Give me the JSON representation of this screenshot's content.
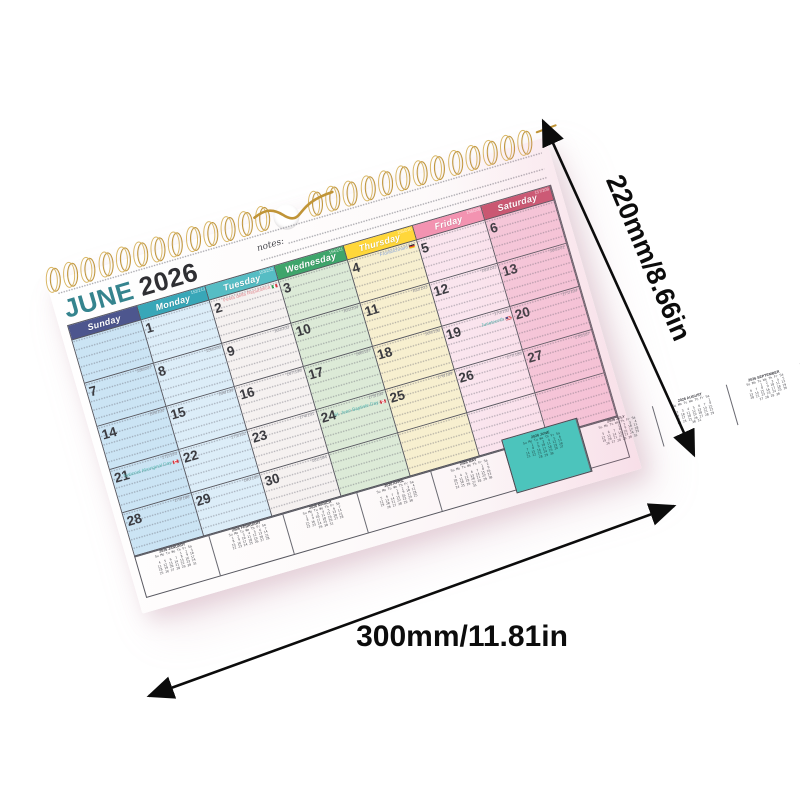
{
  "calendar": {
    "title_month": "JUNE",
    "title_year": "2026",
    "notes_label": "notes:",
    "mini_weekdays": "Su Mo Tu We Th Fr Sa",
    "days": [
      {
        "name": "Sunday",
        "header_num": "",
        "header_color": "#4d568e",
        "cell_color": "#cbe4f4"
      },
      {
        "name": "Monday",
        "header_num": "152/213",
        "header_color": "#38a7b8",
        "cell_color": "#dcedf8"
      },
      {
        "name": "Tuesday",
        "header_num": "153/212",
        "header_color": "#56bdc4",
        "cell_color": "#f5f1f0"
      },
      {
        "name": "Wednesday",
        "header_num": "154/211",
        "header_color": "#3ea56b",
        "cell_color": "#dcead7"
      },
      {
        "name": "Thursday",
        "header_num": "155/210",
        "header_color": "#ffd73a",
        "cell_color": "#f7efcf"
      },
      {
        "name": "Friday",
        "header_num": "156/209",
        "header_color": "#f393b1",
        "cell_color": "#fae5ee"
      },
      {
        "name": "Saturday",
        "header_num": "157/208",
        "header_color": "#c8556f",
        "cell_color": "#f5c9da"
      }
    ],
    "weeks": [
      [
        {
          "d": ""
        },
        {
          "d": "1"
        },
        {
          "d": "2",
          "h": "Festa della Repubblica",
          "f": "it",
          "hc": "#e0888f"
        },
        {
          "d": "3"
        },
        {
          "d": "4",
          "h": "Fronleichnam",
          "f": "de",
          "hc": "#86a3d8"
        },
        {
          "d": "5"
        },
        {
          "d": "6"
        }
      ],
      [
        {
          "d": "7",
          "n": "158/207"
        },
        {
          "d": "8",
          "n": "159/206"
        },
        {
          "d": "9",
          "n": "160/205"
        },
        {
          "d": "10",
          "n": "161/204"
        },
        {
          "d": "11",
          "n": "162/203"
        },
        {
          "d": "12",
          "n": "163/202"
        },
        {
          "d": "13",
          "n": "164/201"
        }
      ],
      [
        {
          "d": "14",
          "n": "165/200"
        },
        {
          "d": "15",
          "n": "166/199"
        },
        {
          "d": "16",
          "n": "167/198"
        },
        {
          "d": "17",
          "n": "168/197"
        },
        {
          "d": "18",
          "n": "169/196"
        },
        {
          "d": "19",
          "n": "170/195",
          "h": "Juneteenth",
          "f": "us",
          "hc": "#57b8b2"
        },
        {
          "d": "20",
          "n": "171/194"
        }
      ],
      [
        {
          "d": "21",
          "n": "172/193",
          "h": "National Aboriginal Day",
          "f": "ca",
          "hc": "#57b8b2"
        },
        {
          "d": "22",
          "n": "173/192"
        },
        {
          "d": "23",
          "n": "174/191"
        },
        {
          "d": "24",
          "n": "175/190",
          "h": "St. Jean Baptiste Day",
          "f": "ca",
          "hc": "#57b8b2"
        },
        {
          "d": "25",
          "n": "176/189"
        },
        {
          "d": "26",
          "n": "177/188"
        },
        {
          "d": "27",
          "n": "178/187"
        }
      ],
      [
        {
          "d": "28",
          "n": "179/186"
        },
        {
          "d": "29",
          "n": "180/185"
        },
        {
          "d": "30",
          "n": "181/184"
        },
        {
          "d": ""
        },
        {
          "d": ""
        },
        {
          "d": ""
        },
        {
          "d": ""
        }
      ]
    ],
    "mini_months": [
      {
        "label": "2026 JANUARY",
        "start": 4,
        "days": 31
      },
      {
        "label": "2026 FEBRUARY",
        "start": 0,
        "days": 28
      },
      {
        "label": "2026 MARCH",
        "start": 0,
        "days": 31
      },
      {
        "label": "2026 APRIL",
        "start": 3,
        "days": 30
      },
      {
        "label": "2026 MAY",
        "start": 5,
        "days": 31
      },
      {
        "label": "2026 JUNE",
        "start": 1,
        "days": 30,
        "current": true
      },
      {
        "label": "2026 JULY",
        "start": 3,
        "days": 31
      },
      {
        "label": "2026 AUGUST",
        "start": 6,
        "days": 31
      },
      {
        "label": "2026 SEPTEMBER",
        "start": 2,
        "days": 30
      },
      {
        "label": "2026 OCTOBER",
        "start": 4,
        "days": 31
      },
      {
        "label": "2026 NOVEMBER",
        "start": 0,
        "days": 30
      },
      {
        "label": "2026 DECEMBER",
        "start": 2,
        "days": 31
      }
    ],
    "colors": {
      "title_month": "#35848e",
      "title_year": "#2f2f33",
      "highlight_mini": "#4cc4bc",
      "binding_wire": "#c09437",
      "arrow": "#0c0c0c"
    }
  },
  "dimensions": {
    "height_label": "220mm/8.66in",
    "width_label": "300mm/11.81in"
  }
}
